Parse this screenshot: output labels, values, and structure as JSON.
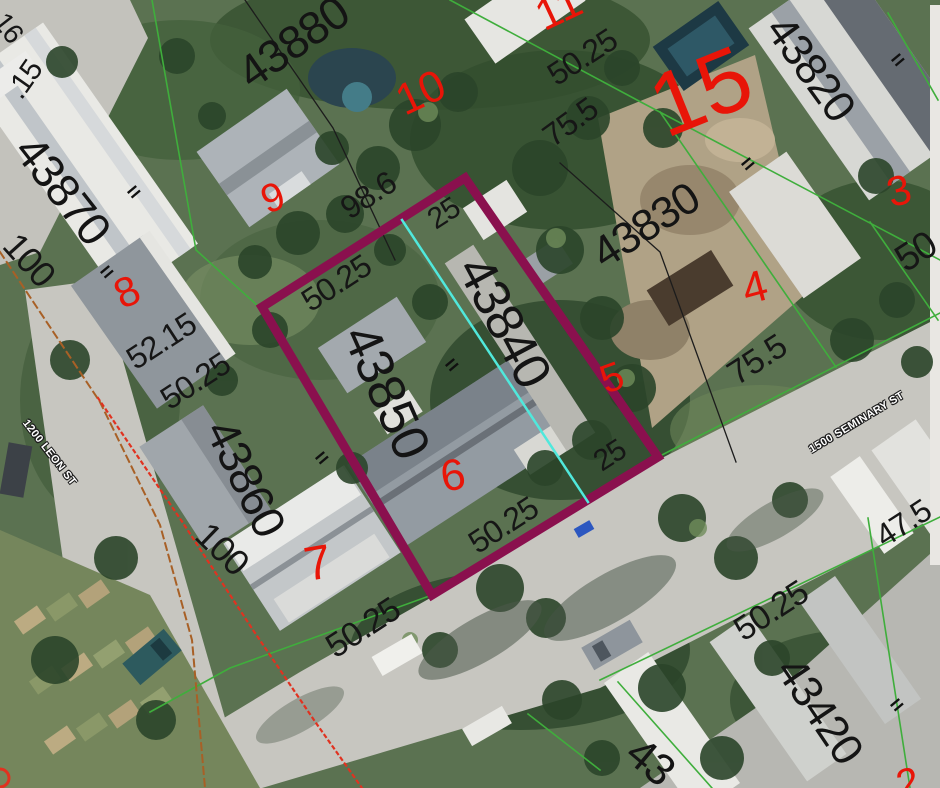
{
  "map": {
    "description_colors": {
      "highlight_parcel": "#8a104e",
      "lot_line_green": "#3fae3c",
      "measure_cyan": "#50e8dc",
      "lot_number_red": "#e81508",
      "boundary_black": "#1c1c1c",
      "easement_orange": "#a86026",
      "easement_red_dotted": "#e03220"
    }
  },
  "labels": {
    "parcel_numbers": [
      {
        "name": "parcel-number-43880",
        "text": "43880",
        "x": 293,
        "y": 42,
        "rot": -35,
        "size": 46
      },
      {
        "name": "parcel-number-43870",
        "text": "43870",
        "x": 63,
        "y": 190,
        "rot": 52,
        "size": 46
      },
      {
        "name": "parcel-number-43860",
        "text": "43860",
        "x": 246,
        "y": 478,
        "rot": 64,
        "size": 46
      },
      {
        "name": "parcel-number-43850",
        "text": "43850",
        "x": 386,
        "y": 392,
        "rot": 66,
        "size": 52
      },
      {
        "name": "parcel-number-43840",
        "text": "43840",
        "x": 504,
        "y": 322,
        "rot": 62,
        "size": 52
      },
      {
        "name": "parcel-number-43830",
        "text": "43830",
        "x": 646,
        "y": 226,
        "rot": -33,
        "size": 44
      },
      {
        "name": "parcel-number-43820",
        "text": "43820",
        "x": 810,
        "y": 69,
        "rot": 54,
        "size": 44
      },
      {
        "name": "parcel-number-43420",
        "text": "43420",
        "x": 819,
        "y": 711,
        "rot": 56,
        "size": 44
      },
      {
        "name": "parcel-number-partial-43",
        "text": "43",
        "x": 650,
        "y": 762,
        "rot": 40,
        "size": 44
      }
    ],
    "dimensions": [
      {
        "name": "dim-partial-16",
        "text": "16",
        "x": 8,
        "y": 28,
        "rot": 52,
        "size": 28
      },
      {
        "name": "dim-partial-15",
        "text": ".15",
        "x": 25,
        "y": 80,
        "rot": -55,
        "size": 30
      },
      {
        "name": "dim-100-upper",
        "text": "100",
        "x": 29,
        "y": 260,
        "rot": 48,
        "size": 36
      },
      {
        "name": "dim-52-15",
        "text": "52.15",
        "x": 161,
        "y": 341,
        "rot": -33,
        "size": 32
      },
      {
        "name": "dim-50-25-leon",
        "text": "50.25",
        "x": 195,
        "y": 381,
        "rot": -33,
        "size": 32
      },
      {
        "name": "dim-98-6",
        "text": "98.6",
        "x": 368,
        "y": 195,
        "rot": -33,
        "size": 32
      },
      {
        "name": "dim-25-top",
        "text": "25",
        "x": 444,
        "y": 214,
        "rot": -33,
        "size": 30
      },
      {
        "name": "dim-50-25-parcel-top",
        "text": "50.25",
        "x": 336,
        "y": 283,
        "rot": -33,
        "size": 32
      },
      {
        "name": "dim-50-25-upper-center",
        "text": "50.25",
        "x": 582,
        "y": 57,
        "rot": -33,
        "size": 32
      },
      {
        "name": "dim-75-5-upper",
        "text": "75.5",
        "x": 570,
        "y": 122,
        "rot": -36,
        "size": 32
      },
      {
        "name": "dim-75-5-right",
        "text": "75.5",
        "x": 757,
        "y": 360,
        "rot": -33,
        "size": 34
      },
      {
        "name": "dim-25-southeast",
        "text": "25",
        "x": 610,
        "y": 456,
        "rot": -33,
        "size": 30
      },
      {
        "name": "dim-50-25-parcel-bottom",
        "text": "50.25",
        "x": 503,
        "y": 525,
        "rot": -33,
        "size": 32
      },
      {
        "name": "dim-50-25-lot7",
        "text": "50.25",
        "x": 363,
        "y": 628,
        "rot": -33,
        "size": 34
      },
      {
        "name": "dim-100-lower",
        "text": "100",
        "x": 222,
        "y": 549,
        "rot": 44,
        "size": 36
      },
      {
        "name": "dim-50-25-southeast",
        "text": "50.25",
        "x": 771,
        "y": 611,
        "rot": -33,
        "size": 34
      },
      {
        "name": "dim-47-5",
        "text": "47.5",
        "x": 903,
        "y": 523,
        "rot": -33,
        "size": 32
      },
      {
        "name": "dim-50-right-edge",
        "text": "50",
        "x": 916,
        "y": 252,
        "rot": -33,
        "size": 38
      }
    ],
    "lot_numbers": [
      {
        "name": "lot-number-8",
        "text": "8",
        "x": 127,
        "y": 292,
        "rot": -25,
        "size": 42
      },
      {
        "name": "lot-number-9",
        "text": "9",
        "x": 273,
        "y": 198,
        "rot": -20,
        "size": 40
      },
      {
        "name": "lot-number-10",
        "text": "10",
        "x": 421,
        "y": 93,
        "rot": -25,
        "size": 44
      },
      {
        "name": "lot-number-11",
        "text": "11",
        "x": 559,
        "y": 9,
        "rot": -25,
        "size": 44
      },
      {
        "name": "lot-number-15",
        "text": "15",
        "x": 701,
        "y": 92,
        "rot": -22,
        "size": 90
      },
      {
        "name": "lot-number-3",
        "text": "3",
        "x": 899,
        "y": 191,
        "rot": -15,
        "size": 42
      },
      {
        "name": "lot-number-4",
        "text": "4",
        "x": 755,
        "y": 288,
        "rot": -15,
        "size": 44
      },
      {
        "name": "lot-number-5",
        "text": "5",
        "x": 612,
        "y": 378,
        "rot": -20,
        "size": 40
      },
      {
        "name": "lot-number-6",
        "text": "6",
        "x": 453,
        "y": 476,
        "rot": -10,
        "size": 44
      },
      {
        "name": "lot-number-7",
        "text": "7",
        "x": 318,
        "y": 564,
        "rot": -10,
        "size": 48
      },
      {
        "name": "lot-number-partial-2",
        "text": "2",
        "x": 908,
        "y": 783,
        "rot": -15,
        "size": 40
      }
    ],
    "street_names": [
      {
        "name": "street-label-leon-st",
        "text": "1200 LEON ST",
        "x": 49,
        "y": 453,
        "rot": 52,
        "size": 11
      },
      {
        "name": "street-label-seminary-st",
        "text": "1500 SEMINARY ST",
        "x": 857,
        "y": 423,
        "rot": -31,
        "size": 11
      }
    ],
    "survey_ticks": [
      {
        "name": "survey-tick-1",
        "text": "=",
        "x": 134,
        "y": 192,
        "rot": -40,
        "size": 22
      },
      {
        "name": "survey-tick-2",
        "text": "=",
        "x": 107,
        "y": 272,
        "rot": -40,
        "size": 22
      },
      {
        "name": "survey-tick-3",
        "text": "=",
        "x": 452,
        "y": 365,
        "rot": -40,
        "size": 22
      },
      {
        "name": "survey-tick-4",
        "text": "=",
        "x": 322,
        "y": 458,
        "rot": -40,
        "size": 22
      },
      {
        "name": "survey-tick-5",
        "text": "=",
        "x": 898,
        "y": 60,
        "rot": -40,
        "size": 22
      },
      {
        "name": "survey-tick-6",
        "text": "=",
        "x": 748,
        "y": 164,
        "rot": -40,
        "size": 22
      },
      {
        "name": "survey-tick-7",
        "text": "=",
        "x": 897,
        "y": 705,
        "rot": -40,
        "size": 22
      }
    ]
  },
  "overlay": {
    "lines": [
      {
        "name": "lot-line-green-rear-west",
        "color": "#3fae3c",
        "width": 1.6,
        "points": "152,0 196,250 258,306"
      },
      {
        "name": "lot-line-green-rear-north",
        "color": "#3fae3c",
        "width": 1.6,
        "points": "450,0 637,100 940,260"
      },
      {
        "name": "lot-line-green-side-43830-43820",
        "color": "#3fae3c",
        "width": 1.6,
        "points": "660,112 836,367"
      },
      {
        "name": "lot-line-green-side-43820-lot3",
        "color": "#3fae3c",
        "width": 1.6,
        "points": "870,222 938,320"
      },
      {
        "name": "lot-line-green-front-seminary-ne",
        "color": "#3fae3c",
        "width": 1.6,
        "points": "658,457 940,313"
      },
      {
        "name": "lot-line-green-front-seminary-sw",
        "color": "#3fae3c",
        "width": 1.6,
        "points": "432,595 230,668 150,712"
      },
      {
        "name": "lot-line-green-front-seminary-se",
        "color": "#3fae3c",
        "width": 1.6,
        "points": "600,680 940,517"
      },
      {
        "name": "lot-line-green-43420-side-a",
        "color": "#3fae3c",
        "width": 1.6,
        "points": "868,518 910,788"
      },
      {
        "name": "lot-line-green-43420-side-b",
        "color": "#3fae3c",
        "width": 1.6,
        "points": "618,682 712,788"
      },
      {
        "name": "lot-line-green-northeast-corner",
        "color": "#3fae3c",
        "width": 1.6,
        "points": "888,13 938,100"
      },
      {
        "name": "lot-line-green-bottom-center",
        "color": "#3fae3c",
        "width": 1.6,
        "points": "528,714 600,770"
      },
      {
        "name": "boundary-black-northwest",
        "color": "#1c1c1c",
        "width": 1.3,
        "points": "245,0 333,128 395,260"
      },
      {
        "name": "boundary-black-43830",
        "color": "#1c1c1c",
        "width": 1.3,
        "points": "560,163 660,252 736,462"
      },
      {
        "name": "easement-orange-dashed-leon",
        "color": "#a86026",
        "width": 2,
        "dash": "7 5",
        "points": "0,252 100,402 160,525 192,640 205,788"
      },
      {
        "name": "easement-red-dotted-leon",
        "color": "#e03220",
        "width": 2.2,
        "dash": "2.5 4.5",
        "points": "98,398 183,523 253,630 316,723 362,788"
      },
      {
        "name": "highlighted-parcel-boundary",
        "color": "#8a104e",
        "width": 9,
        "points": "262,307 465,178 658,457 432,595 262,307 465,178"
      },
      {
        "name": "measure-line-cyan",
        "color": "#50e8dc",
        "width": 2.5,
        "points": "402,220 588,502"
      }
    ]
  }
}
